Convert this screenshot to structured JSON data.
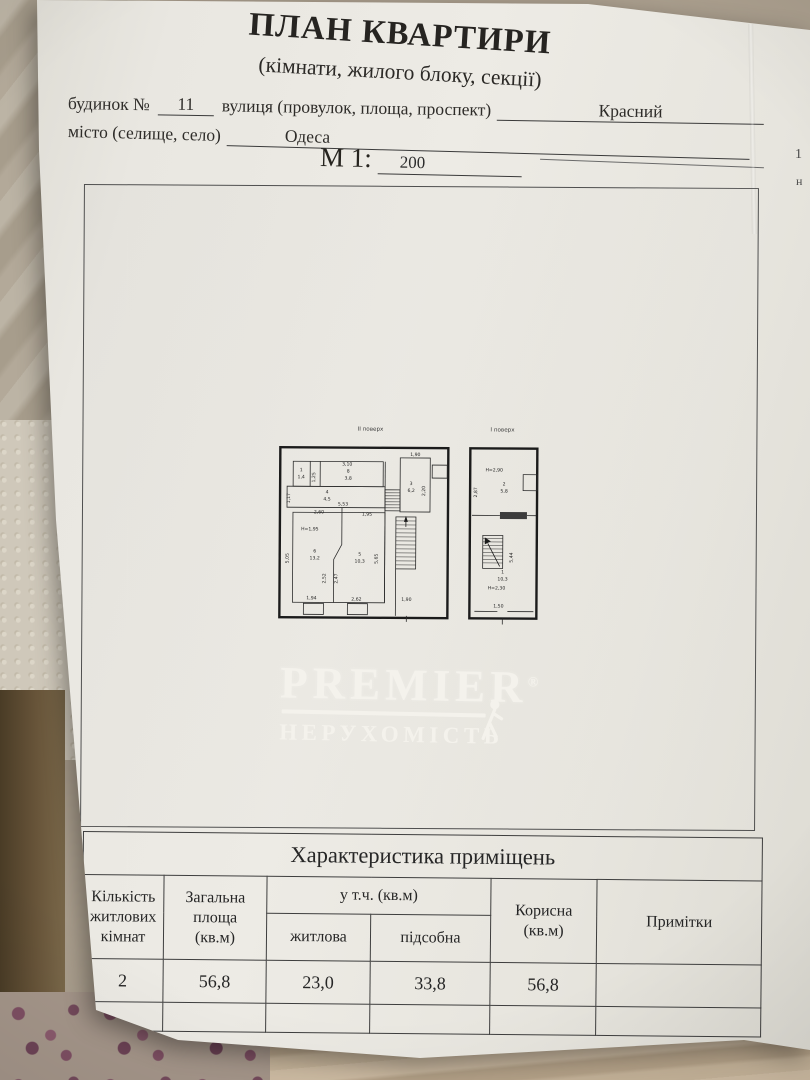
{
  "document": {
    "title": "ПЛАН КВАРТИРИ",
    "subtitle": "(кімнати, жилого блоку, секції)",
    "form": {
      "building_label": "будинок №",
      "building_value": "11",
      "street_label": "вулиця (провулок, площа, проспект)",
      "street_value": "Красний",
      "city_label": "місто (селище, село)",
      "city_value": "Одеса",
      "scale_label": "М 1:",
      "scale_value": "200"
    },
    "edge_fragments": [
      "1",
      "н"
    ]
  },
  "floor_plans": {
    "second_floor": {
      "title": "ІІ поверх",
      "labels": [
        {
          "t": "3,10",
          "x": 77,
          "y": 51
        },
        {
          "t": "1",
          "x": 31,
          "y": 57
        },
        {
          "t": "1,4",
          "x": 31,
          "y": 64
        },
        {
          "t": "1,25",
          "x": 45,
          "y": 63,
          "r": -90
        },
        {
          "t": "8",
          "x": 78,
          "y": 58
        },
        {
          "t": "3,8",
          "x": 78,
          "y": 65
        },
        {
          "t": "1,17",
          "x": 20,
          "y": 84,
          "r": -90
        },
        {
          "t": "4",
          "x": 57,
          "y": 79
        },
        {
          "t": "4,5",
          "x": 57,
          "y": 86
        },
        {
          "t": "5,53",
          "x": 73,
          "y": 91
        },
        {
          "t": "2,60",
          "x": 49,
          "y": 99
        },
        {
          "t": "1,95",
          "x": 97,
          "y": 101
        },
        {
          "t": "Н=1,95",
          "x": 40,
          "y": 116
        },
        {
          "t": "6",
          "x": 45,
          "y": 138
        },
        {
          "t": "13,2",
          "x": 45,
          "y": 145
        },
        {
          "t": "5",
          "x": 90,
          "y": 141
        },
        {
          "t": "10,3",
          "x": 90,
          "y": 148
        },
        {
          "t": "5,05",
          "x": 19,
          "y": 144,
          "r": -90
        },
        {
          "t": "2,52",
          "x": 56,
          "y": 164,
          "r": -90
        },
        {
          "t": "2,47",
          "x": 68,
          "y": 164,
          "r": -90
        },
        {
          "t": "5,65",
          "x": 108,
          "y": 144,
          "r": -90
        },
        {
          "t": "1,94",
          "x": 42,
          "y": 185
        },
        {
          "t": "2,62",
          "x": 87,
          "y": 186
        },
        {
          "t": "1,90",
          "x": 145,
          "y": 41
        },
        {
          "t": "3",
          "x": 141,
          "y": 70
        },
        {
          "t": "6,2",
          "x": 141,
          "y": 77
        },
        {
          "t": "2,20",
          "x": 155,
          "y": 76,
          "r": -90
        },
        {
          "t": "1,90",
          "x": 137,
          "y": 186
        }
      ]
    },
    "first_floor": {
      "title": "І поверх",
      "labels": [
        {
          "t": "Н=2,90",
          "x": 224,
          "y": 56
        },
        {
          "t": "2",
          "x": 234,
          "y": 70
        },
        {
          "t": "5,8",
          "x": 234,
          "y": 77
        },
        {
          "t": "2,87",
          "x": 207,
          "y": 77,
          "r": -90
        },
        {
          "t": "5,44",
          "x": 243,
          "y": 142,
          "r": -90
        },
        {
          "t": "1",
          "x": 233,
          "y": 158
        },
        {
          "t": "10,3",
          "x": 233,
          "y": 165
        },
        {
          "t": "Н=2,30",
          "x": 227,
          "y": 174
        },
        {
          "t": "1,50",
          "x": 229,
          "y": 192
        }
      ]
    }
  },
  "logo": {
    "brand": "PREMIER",
    "registered": "®",
    "tagline": "НЕРУХОМІСТЬ"
  },
  "table": {
    "title": "Характеристика приміщень",
    "headers": {
      "rooms": "Кількість\nжитлових\nкімнат",
      "total_area": "Загальна\nплоща\n(кв.м)",
      "including": "у т.ч. (кв.м)",
      "living": "житлова",
      "auxiliary": "підсобна",
      "useful": "Корисна\n(кв.м)",
      "notes": "Примітки"
    },
    "row": {
      "rooms": "2",
      "total_area": "56,8",
      "living": "23,0",
      "auxiliary": "33,8",
      "useful": "56,8",
      "notes": ""
    }
  },
  "colors": {
    "paper": "#e9e7e1",
    "ink": "#2b2b2b",
    "wall": "#1b1b1b",
    "logo_white": "#f5f3ed",
    "table_border": "#3e3e3e"
  }
}
